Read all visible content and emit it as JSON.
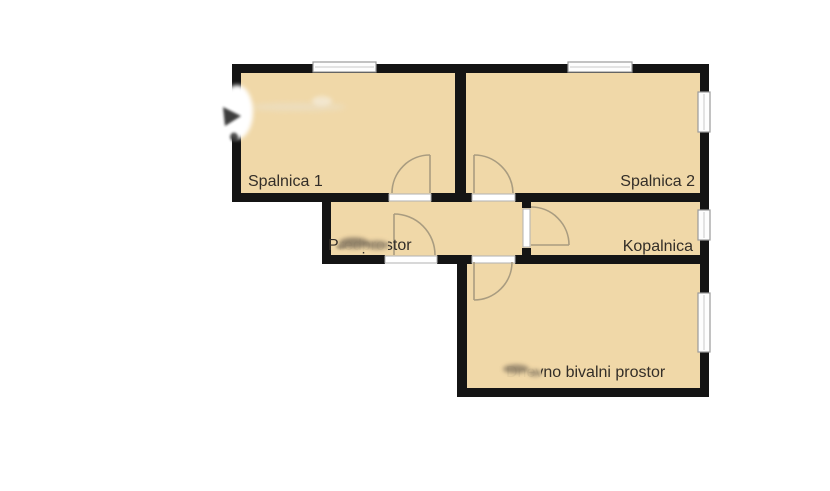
{
  "colors": {
    "background": "#ffffff",
    "room_fill": "#f0d8a8",
    "wall": "#141414",
    "door_arc": "#a99c80",
    "window_border": "#9a9a9a",
    "label_text": "#332e28"
  },
  "rooms": {
    "spalnica1": {
      "label": "Spalnica 1"
    },
    "spalnica2": {
      "label": "Spalnica 2"
    },
    "predprostor": {
      "label": "Predprostor"
    },
    "kopalnica": {
      "label": "Kopalnica"
    },
    "living": {
      "label": "Dnevno bivalni prostor"
    }
  }
}
